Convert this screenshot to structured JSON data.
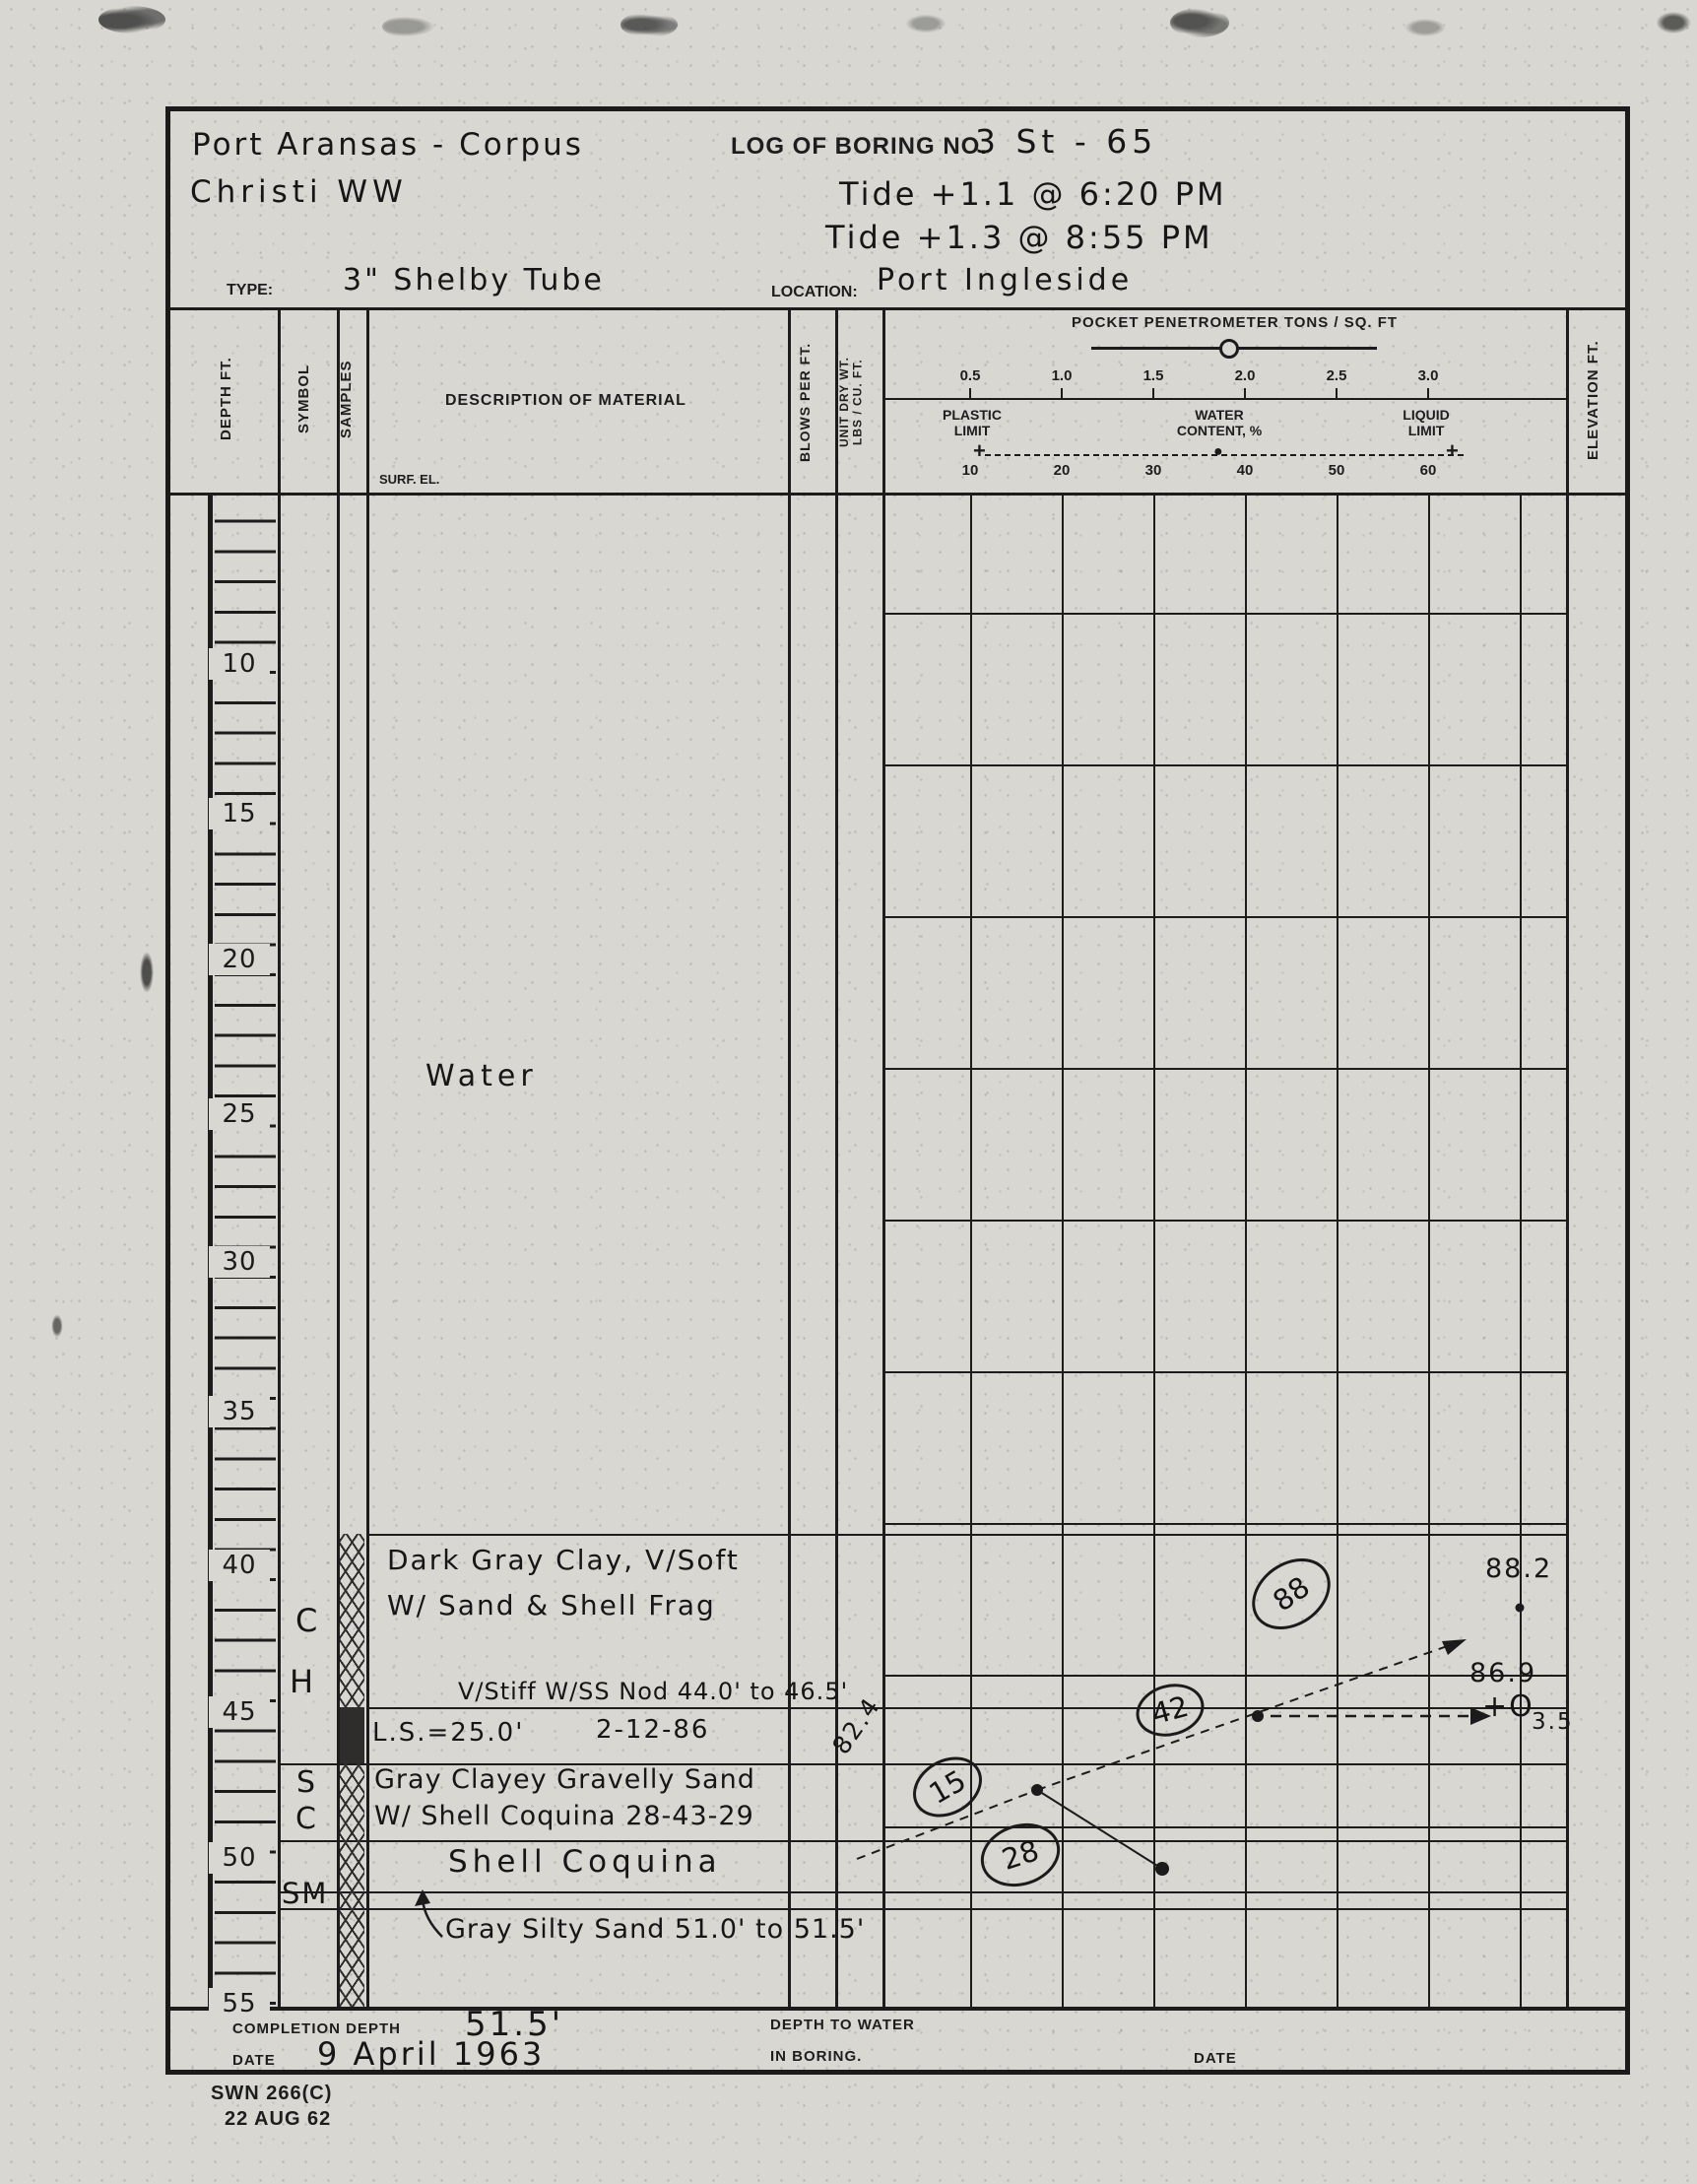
{
  "header": {
    "project_line1": "Port Aransas - Corpus",
    "project_line2": "Christi WW",
    "log_of_boring_label": "LOG OF BORING NO.",
    "boring_number": "3 St - 65",
    "tide_note_1": "Tide +1.1 @ 6:20 PM",
    "tide_note_2": "Tide +1.3 @ 8:55 PM",
    "type_label": "TYPE:",
    "type_value": "3\" Shelby Tube",
    "location_label": "LOCATION:",
    "location_value": "Port Ingleside"
  },
  "table_header": {
    "depth": "DEPTH FT.",
    "symbol": "SYMBOL",
    "samples": "SAMPLES",
    "description": "DESCRIPTION OF MATERIAL",
    "surf_el": "SURF. EL.",
    "blows_per_ft": "BLOWS PER FT.",
    "unit_dry_wt_line1": "UNIT DRY WT.",
    "unit_dry_wt_line2": "LBS / CU. FT.",
    "elevation": "ELEVATION FT.",
    "penetrometer_title": "POCKET PENETROMETER  TONS / SQ. FT",
    "penetrometer_scale": [
      "0.5",
      "1.0",
      "1.5",
      "2.0",
      "2.5",
      "3.0"
    ],
    "plastic_limit_label": "PLASTIC LIMIT",
    "water_content_label": "WATER CONTENT, %",
    "liquid_limit_label": "LIQUID LIMIT",
    "plastic_marker": "+",
    "water_marker": "●",
    "liquid_marker": "+",
    "water_content_scale": [
      "10",
      "20",
      "30",
      "40",
      "50",
      "60"
    ]
  },
  "depth_scale": {
    "labels": [
      "10",
      "15",
      "20",
      "25",
      "30",
      "35",
      "40",
      "45",
      "50",
      "55"
    ]
  },
  "log": {
    "water_note": "Water",
    "layer1_symbol_1": "C",
    "layer1_symbol_2": "H",
    "layer1_line1": "Dark Gray Clay, V/Soft",
    "layer1_line2": "W/ Sand & Shell Frag",
    "layer1_note": "V/Stiff W/SS Nod 44.0' to 46.5'",
    "layer1_ls_note": "L.S.=25.0'",
    "layer1_date_note": "2-12-86",
    "layer1_unit_dry_wt": "82.4",
    "layer2_symbol_1": "S",
    "layer2_symbol_2": "C",
    "layer2_line1": "Gray Clayey Gravelly Sand",
    "layer2_line2": "W/ Shell Coquina  28-43-29",
    "layer3_name": "Shell Coquina",
    "layer4_symbol": "SM",
    "layer4_note": "Gray Silty Sand 51.0' to 51.5'"
  },
  "plot": {
    "wc_88": "88",
    "wc_42": "42",
    "wc_15": "15",
    "wc_28": "28",
    "label_88_2": "88.2",
    "label_86_9": "86.9",
    "liquid_marker_note": "+O",
    "liquid_marker_value": "3.5"
  },
  "footer": {
    "completion_depth_label": "COMPLETION DEPTH",
    "completion_depth_value": "51.5'",
    "date_label": "DATE",
    "date_value": "9 April 1963",
    "depth_to_water_line1": "DEPTH TO WATER",
    "depth_to_water_line2": "IN BORING.",
    "date_right_label": "DATE"
  },
  "stamp": {
    "form_number": "SWN 266(C)",
    "form_date": "22 AUG 62"
  }
}
